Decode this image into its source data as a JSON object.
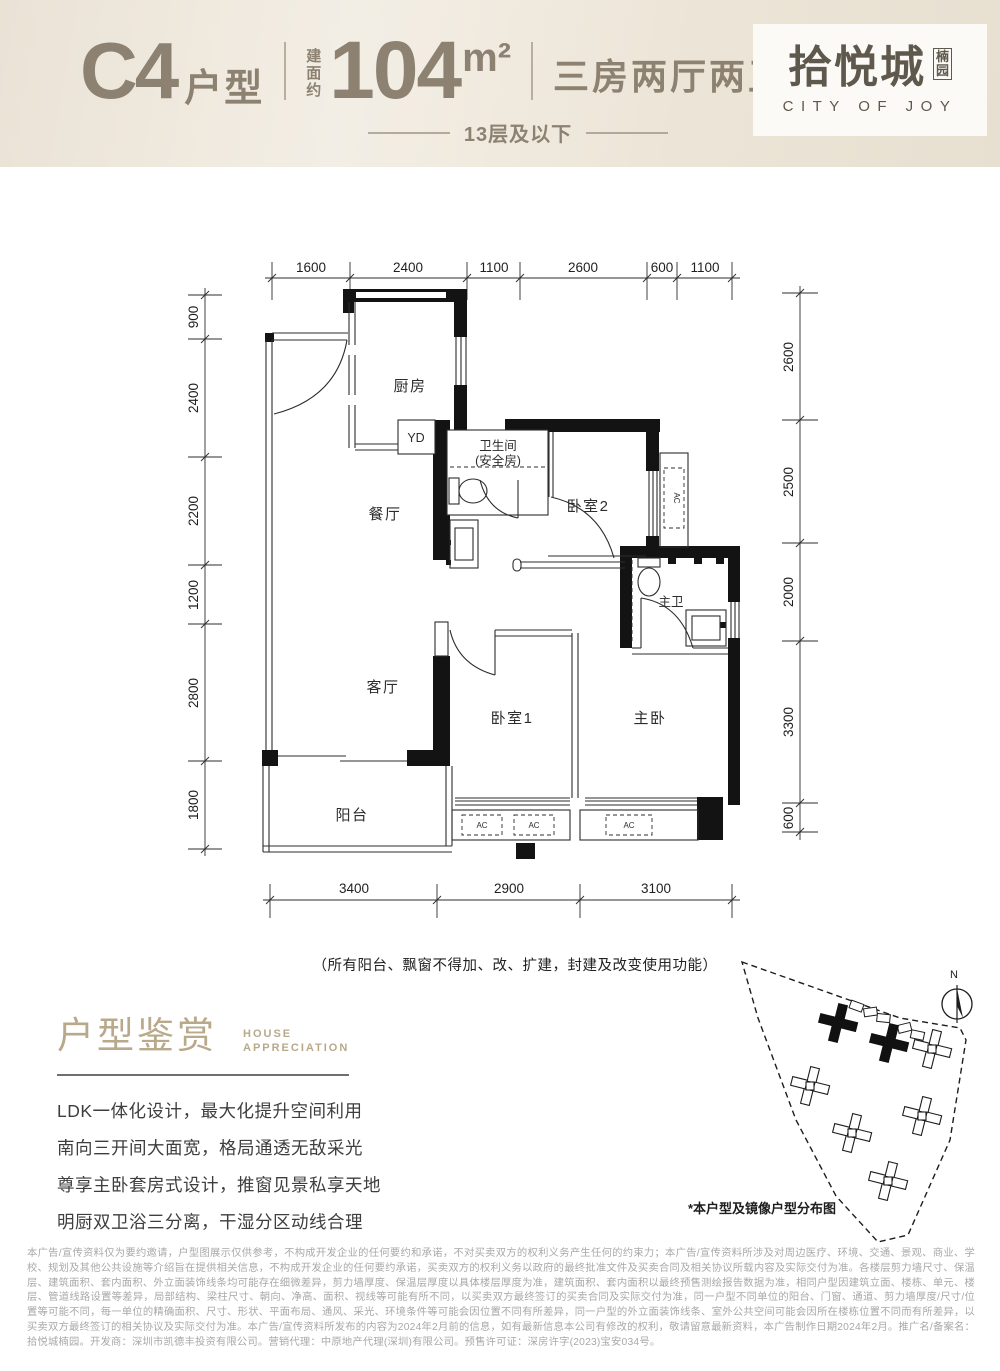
{
  "header": {
    "unit": "C4",
    "unit_suffix": "户型",
    "area_prefix_chars": [
      "建",
      "面",
      "约"
    ],
    "area_value": "104",
    "area_unit": "m²",
    "rooms": "三房两厅两卫",
    "floors": "13层及以下",
    "logo_cn": "拾悦城",
    "logo_sub_chars": [
      "楠",
      "园"
    ],
    "logo_en": "CITY OF JOY"
  },
  "plan": {
    "dims_top": [
      "1600",
      "2400",
      "1100",
      "2600",
      "600",
      "1100"
    ],
    "dims_left": [
      "900",
      "2400",
      "2200",
      "1200",
      "2800",
      "1800"
    ],
    "dims_right": [
      "2600",
      "2500",
      "2000",
      "3300",
      "600"
    ],
    "dims_bottom": [
      "3400",
      "2900",
      "3100"
    ],
    "rooms": {
      "kitchen": "厨房",
      "dining": "餐厅",
      "living": "客厅",
      "balcony": "阳台",
      "bath_line1": "卫生间",
      "bath_line2": "(安全房)",
      "bedroom2": "卧室2",
      "master_bath": "主卫",
      "bedroom1": "卧室1",
      "master": "主卧",
      "yd": "YD",
      "ac": "AC"
    },
    "note": "（所有阳台、飘窗不得加、改、扩建，封建及改变使用功能）"
  },
  "appreciation": {
    "title": "户型鉴赏",
    "subtitle_line1": "HOUSE",
    "subtitle_line2": "APPRECIATION",
    "points": [
      "LDK一体化设计，最大化提升空间利用",
      "南向三开间大面宽，格局通透无敌采光",
      "尊享主卧套房式设计，推窗见景私享天地",
      "明厨双卫浴三分离，干湿分区动线合理"
    ]
  },
  "siteplan": {
    "caption": "*本户型及镜像户型分布图",
    "north": "N"
  },
  "disclaimer": "本广告/宣传资料仅为要约邀请，户型图展示仅供参考，不构成开发企业的任何要约和承诺，不对买卖双方的权利义务产生任何的约束力；本广告/宣传资料所涉及对周边医疗、环境、交通、景观、商业、学校、规划及其他公共设施等介绍旨在提供相关信息，不构成开发企业的任何要约承诺，买卖双方的权利义务以政府的最终批准文件及买卖合同及相关协议所载内容及实际交付为准。各楼层剪力墙尺寸、保温层、建筑面积、套内面积、外立面装饰线条均可能存在细微差异，剪力墙厚度、保温层厚度以具体楼层厚度为准，建筑面积、套内面积以最终预售测绘报告数据为准，相同户型因建筑立面、楼栋、单元、楼层、管道线路设置等差异，局部结构、梁柱尺寸、朝向、净高、面积、视线等可能有所不同，以买卖双方最终签订的买卖合同及实际交付为准，同一户型不同单位的阳台、门窗、通道、剪力墙厚度/尺寸/位置等可能不同，每一单位的精确面积、尺寸、形状、平面布局、通风、采光、环境条件等可能会因位置不同有所差异，同一户型的外立面装饰线条、室外公共空间可能会因所在楼栋位置不同而有所差异，以买卖双方最终签订的相关协议及实际交付为准。本广告/宣传资料所发布的内容为2024年2月前的信息，如有最新信息本公司有修改的权利，敬请留意最新资料，本广告制作日期2024年2月。推广名/备案名：拾悦城楠园。开发商：深圳市凯德丰投资有限公司。营销代理：中原地产代理(深圳)有限公司。预售许可证：深房许字(2023)宝安034号。"
}
